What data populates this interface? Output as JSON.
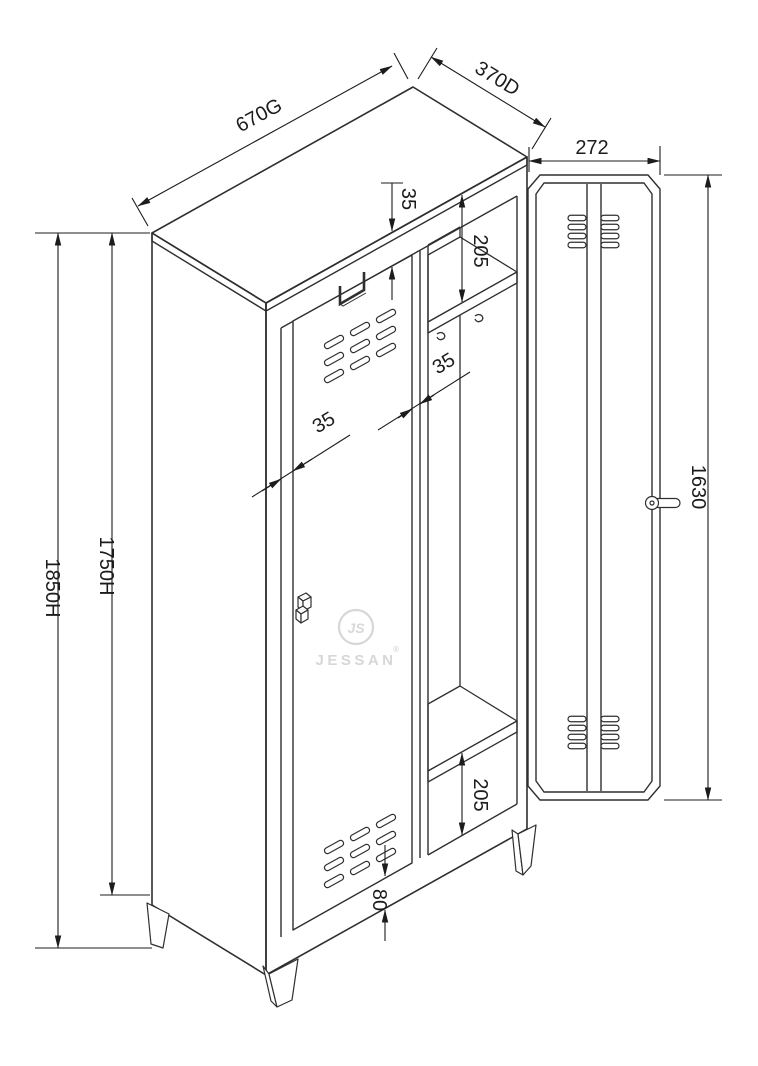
{
  "dimensions": {
    "width": "670G",
    "depth": "370D",
    "open_door_width": "272",
    "overall_height": "1850H",
    "body_height": "1750H",
    "door_height": "1630",
    "top_rail_gap": "35",
    "top_shelf_offset": "205",
    "left_door_edge": "35",
    "mid_door_edge": "35",
    "bottom_shelf_offset": "205",
    "base_rail": "80"
  },
  "watermark": {
    "monogram": "JS",
    "brand": "JESSAN",
    "registered_mark": "®"
  },
  "colors": {
    "line": "#2f2f2f",
    "dimension": "#1c1c1c",
    "watermark": "#d7d7d7",
    "background": "#ffffff"
  }
}
